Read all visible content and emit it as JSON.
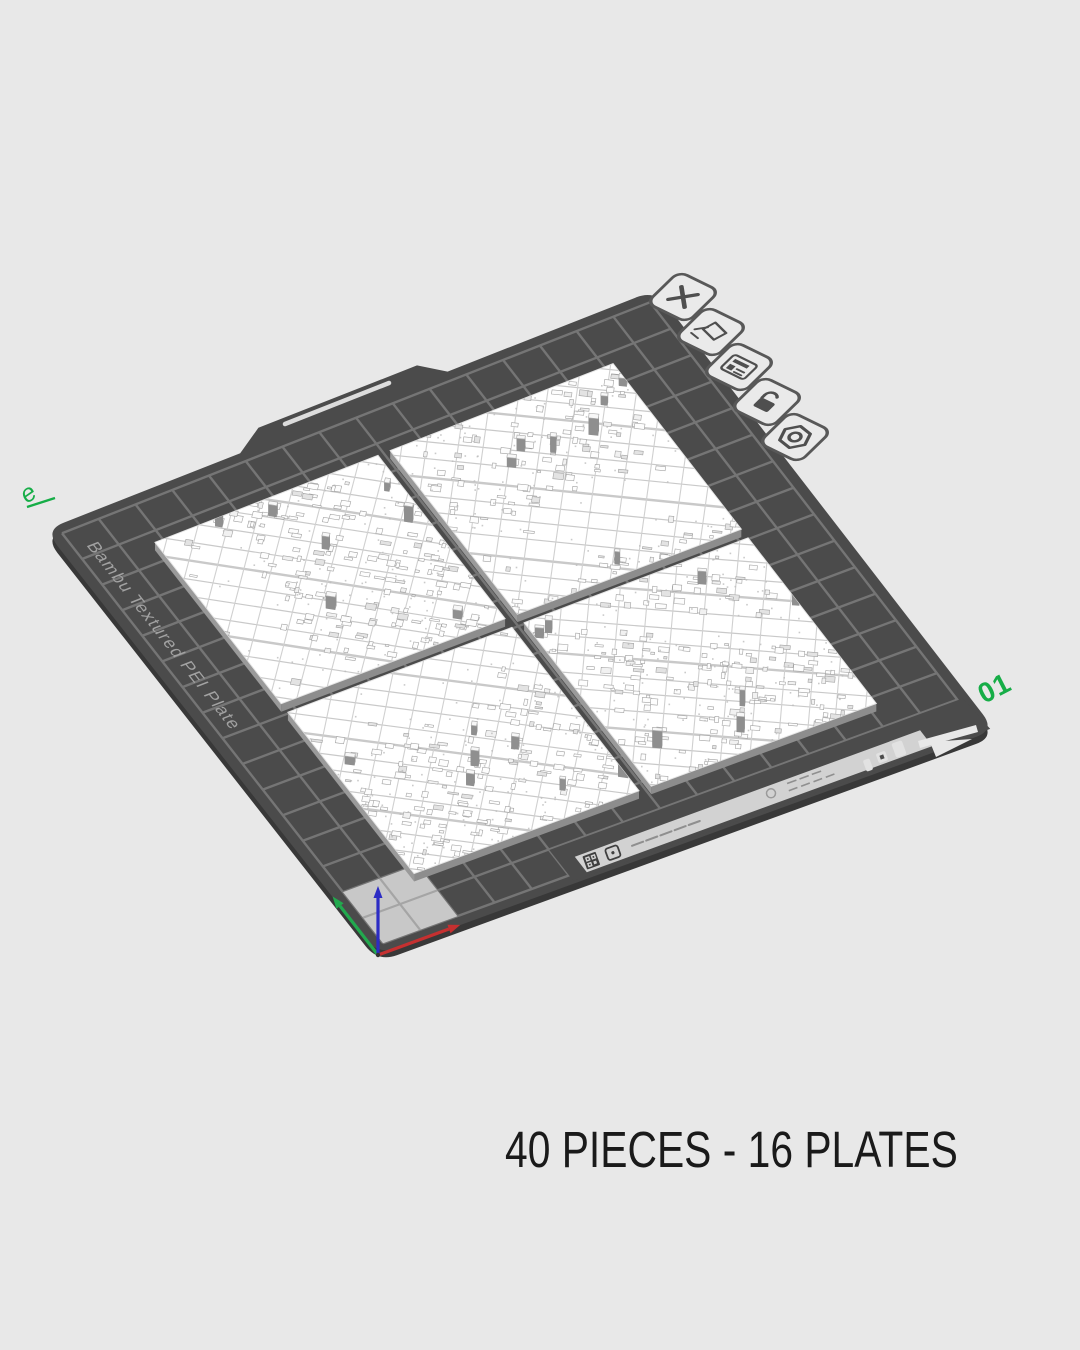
{
  "view": {
    "background": "#e8e8e8",
    "caption": "40 PIECES - 16 PLATES"
  },
  "plate": {
    "label": "01",
    "brand_text": "Bambu Textured PEI Plate",
    "corner_mark": "e",
    "grid_cells": 16,
    "surface_color": "#4b4b4b",
    "grid_line_color": "#757575",
    "accent_green": "#16ad47"
  },
  "plate_toolbar": {
    "icons": [
      {
        "name": "delete-plate",
        "glyph": "close"
      },
      {
        "name": "edit-plate-name",
        "glyph": "rename"
      },
      {
        "name": "plate-arrange",
        "glyph": "form"
      },
      {
        "name": "lock-plate",
        "glyph": "lock-open"
      },
      {
        "name": "plate-settings",
        "glyph": "gear"
      }
    ]
  },
  "models": {
    "count": 4,
    "kind": "city-map-tiles",
    "color": "#ffffff"
  },
  "axes": {
    "x_color": "#c53030",
    "y_color": "#22a94e",
    "z_color": "#2c2cc4"
  }
}
